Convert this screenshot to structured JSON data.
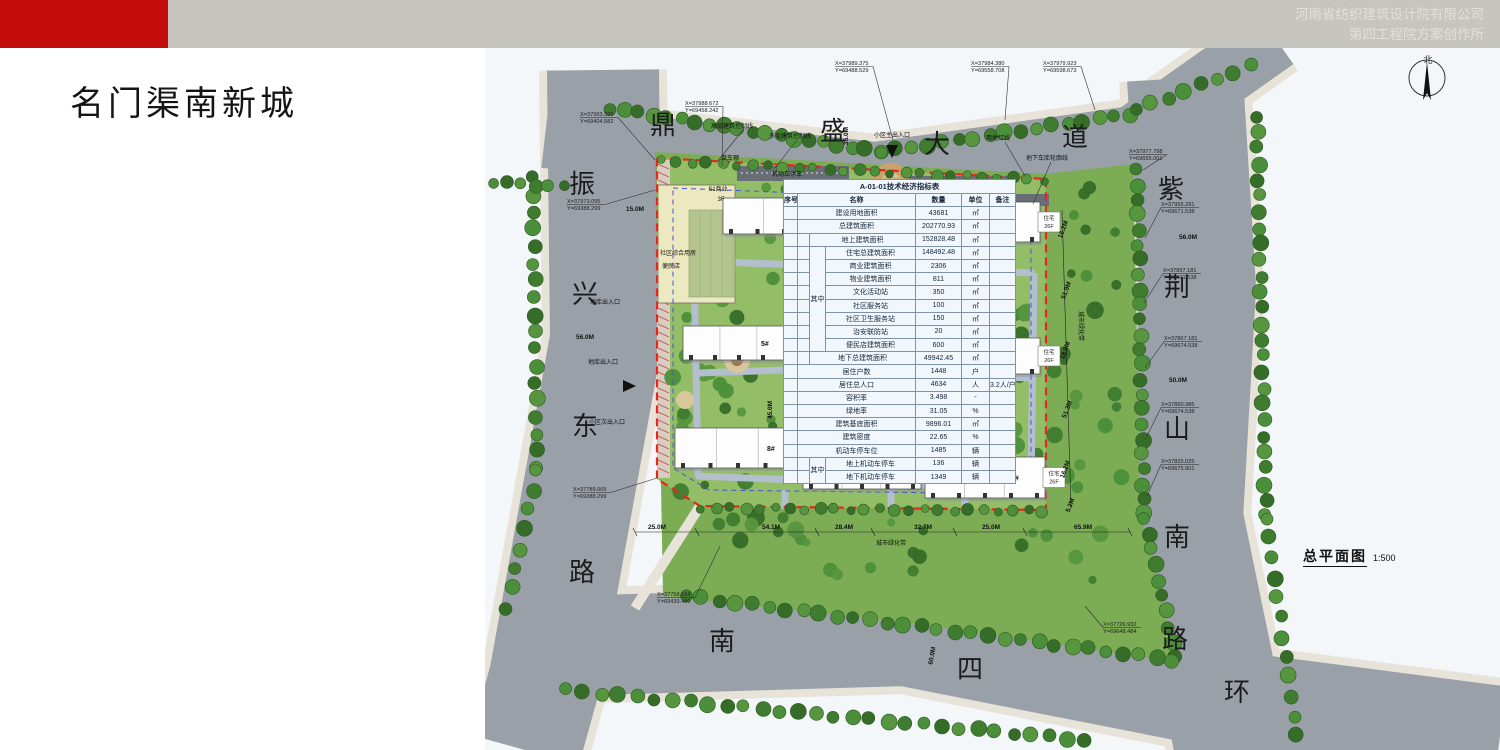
{
  "header": {
    "company_line1": "河南省纺织建筑设计院有限公司",
    "company_line2": "第四工程院方案创作所",
    "accent_color": "#c30d0d",
    "bar_color": "#c7c5bf"
  },
  "title": "名门渠南新城",
  "plan": {
    "caption": {
      "text": "总平面图",
      "scale": "1:500"
    },
    "north_label": "北",
    "colors": {
      "road": "#9aa0a8",
      "lawn": "#93bd66",
      "belt": "#7cad55",
      "boundary_red": "#e8271c",
      "garage_blue": "#4854d8"
    },
    "road_names": [
      {
        "ch": "振",
        "x": 97,
        "y": 145
      },
      {
        "ch": "兴",
        "x": 100,
        "y": 255
      },
      {
        "ch": "东",
        "x": 100,
        "y": 387
      },
      {
        "ch": "路",
        "x": 97,
        "y": 533
      },
      {
        "ch": "鼎",
        "x": 178,
        "y": 86
      },
      {
        "ch": "盛",
        "x": 348,
        "y": 92
      },
      {
        "ch": "大",
        "x": 452,
        "y": 105
      },
      {
        "ch": "道",
        "x": 590,
        "y": 98
      },
      {
        "ch": "紫",
        "x": 686,
        "y": 150
      },
      {
        "ch": "荆",
        "x": 692,
        "y": 248
      },
      {
        "ch": "山",
        "x": 692,
        "y": 390
      },
      {
        "ch": "南",
        "x": 692,
        "y": 498
      },
      {
        "ch": "路",
        "x": 690,
        "y": 600
      },
      {
        "ch": "南",
        "x": 237,
        "y": 602
      },
      {
        "ch": "四",
        "x": 485,
        "y": 630
      },
      {
        "ch": "环",
        "x": 752,
        "y": 653
      }
    ],
    "coords": [
      {
        "x": 95,
        "y": 63,
        "X": "X=37993.320",
        "Y": "Y=69404.582",
        "tx": 170,
        "ty": 112
      },
      {
        "x": 200,
        "y": 52,
        "X": "X=37988.672",
        "Y": "Y=69458.242",
        "tx": 237,
        "ty": 118
      },
      {
        "x": 350,
        "y": 12,
        "X": "X=37989.375",
        "Y": "Y=69488.529",
        "tx": 408,
        "ty": 92
      },
      {
        "x": 486,
        "y": 12,
        "X": "X=37984.380",
        "Y": "Y=69558.708",
        "tx": 520,
        "ty": 72
      },
      {
        "x": 558,
        "y": 12,
        "X": "X=37979.923",
        "Y": "Y=69598.673",
        "tx": 610,
        "ty": 62
      },
      {
        "x": 644,
        "y": 100,
        "X": "X=37977.798",
        "Y": "Y=69655.001",
        "tx": 658,
        "ty": 122
      },
      {
        "x": 676,
        "y": 153,
        "X": "X=37955.291",
        "Y": "Y=69671.538",
        "tx": 660,
        "ty": 190
      },
      {
        "x": 678,
        "y": 219,
        "X": "X=37897.181",
        "Y": "Y=69671.538",
        "tx": 659,
        "ty": 255
      },
      {
        "x": 679,
        "y": 287,
        "X": "X=37867.181",
        "Y": "Y=69674.538",
        "tx": 660,
        "ty": 320
      },
      {
        "x": 676,
        "y": 353,
        "X": "X=37860.986",
        "Y": "Y=69674.538",
        "tx": 660,
        "ty": 392
      },
      {
        "x": 676,
        "y": 410,
        "X": "X=37825.025",
        "Y": "Y=69675.901",
        "tx": 662,
        "ty": 448
      },
      {
        "x": 82,
        "y": 150,
        "X": "X=37973.095",
        "Y": "Y=69388.299",
        "tx": 170,
        "ty": 142
      },
      {
        "x": 88,
        "y": 438,
        "X": "X=37789.065",
        "Y": "Y=69388.299",
        "tx": 172,
        "ty": 430
      },
      {
        "x": 172,
        "y": 543,
        "X": "X=37758.164",
        "Y": "Y=69439.480",
        "tx": 235,
        "ty": 498
      },
      {
        "x": 618,
        "y": 573,
        "X": "X=37726.932",
        "Y": "Y=69648.484",
        "tx": 600,
        "ty": 558
      }
    ],
    "dims": [
      {
        "t": "35.0M",
        "x": 363,
        "y": 88,
        "r": -90
      },
      {
        "t": "29.6M",
        "x": 407,
        "y": 172,
        "r": 0
      },
      {
        "t": "96.0M",
        "x": 390,
        "y": 291,
        "r": 0
      },
      {
        "t": "45.0M",
        "x": 287,
        "y": 362,
        "r": -90
      },
      {
        "t": "15.0M",
        "x": 150,
        "y": 163,
        "r": 0
      },
      {
        "t": "56.0M",
        "x": 100,
        "y": 291,
        "r": 0
      },
      {
        "t": "56.0M",
        "x": 703,
        "y": 191,
        "r": 0
      },
      {
        "t": "50.0M",
        "x": 693,
        "y": 334,
        "r": 0
      },
      {
        "t": "60.0M",
        "x": 449,
        "y": 608,
        "r": -80
      },
      {
        "t": "16.2M",
        "x": 580,
        "y": 182,
        "r": -70
      },
      {
        "t": "51.9M",
        "x": 583,
        "y": 243,
        "r": -70
      },
      {
        "t": "18.9M",
        "x": 582,
        "y": 303,
        "r": -70
      },
      {
        "t": "51.3M",
        "x": 584,
        "y": 362,
        "r": -70
      },
      {
        "t": "16.2M",
        "x": 582,
        "y": 422,
        "r": -70
      },
      {
        "t": "5.2M",
        "x": 587,
        "y": 458,
        "r": -70
      },
      {
        "t": "25.0M",
        "x": 172,
        "y": 481,
        "r": 0
      },
      {
        "t": "54.1M",
        "x": 286,
        "y": 481,
        "r": 0
      },
      {
        "t": "28.4M",
        "x": 359,
        "y": 481,
        "r": 0
      },
      {
        "t": "32.7M",
        "x": 438,
        "y": 481,
        "r": 0
      },
      {
        "t": "25.0M",
        "x": 506,
        "y": 481,
        "r": 0
      },
      {
        "t": "65.9M",
        "x": 598,
        "y": 481,
        "r": 0
      }
    ],
    "annotations": [
      {
        "t": "高层建筑控制线",
        "x": 247,
        "y": 80,
        "r": 0
      },
      {
        "t": "多层建筑控制线",
        "x": 305,
        "y": 90,
        "r": 0
      },
      {
        "t": "小区主出入口",
        "x": 407,
        "y": 89,
        "r": 0
      },
      {
        "t": "用地红线",
        "x": 513,
        "y": 92,
        "r": 0
      },
      {
        "t": "地下车库轮廓线",
        "x": 562,
        "y": 112,
        "r": 0
      },
      {
        "t": "机动车停车",
        "x": 302,
        "y": 128,
        "r": 0
      },
      {
        "t": "单车棚",
        "x": 245,
        "y": 112,
        "r": 0
      },
      {
        "t": "地库出入口",
        "x": 120,
        "y": 256,
        "r": 0
      },
      {
        "t": "地库出入口",
        "x": 118,
        "y": 316,
        "r": 0
      },
      {
        "t": "小区次出入口",
        "x": 122,
        "y": 376,
        "r": 0
      },
      {
        "t": "城市绿化带",
        "x": 594,
        "y": 278,
        "r": 90
      },
      {
        "t": "城市绿化带",
        "x": 406,
        "y": 497,
        "r": 0
      },
      {
        "t": "社区综合用房",
        "x": 193,
        "y": 207,
        "r": 0
      },
      {
        "t": "便民店",
        "x": 186,
        "y": 220,
        "r": 0
      },
      {
        "t": "S1商业",
        "x": 233,
        "y": 143,
        "r": 0
      },
      {
        "t": "3F",
        "x": 236,
        "y": 153,
        "r": 0
      }
    ],
    "buildings": [
      {
        "id": "2#",
        "x": 238,
        "y": 150,
        "w": 122,
        "h": 36,
        "use": "住宅",
        "floors": "26F"
      },
      {
        "id": "1#",
        "x": 420,
        "y": 154,
        "w": 135,
        "h": 40,
        "use": "住宅",
        "floors": "26F"
      },
      {
        "id": "5#",
        "x": 198,
        "y": 278,
        "w": 112,
        "h": 34,
        "use": "住宅",
        "floors": "26F"
      },
      {
        "id": "3#",
        "x": 452,
        "y": 290,
        "w": 103,
        "h": 36,
        "use": "住宅",
        "floors": "26F"
      },
      {
        "id": "8#",
        "x": 190,
        "y": 380,
        "w": 126,
        "h": 40,
        "use": "住宅",
        "floors": "26F"
      },
      {
        "id": "7#",
        "x": 318,
        "y": 403,
        "w": 118,
        "h": 38,
        "use": "住宅",
        "floors": "26F"
      },
      {
        "id": "6#",
        "x": 440,
        "y": 409,
        "w": 120,
        "h": 41,
        "use": "住宅",
        "floors": "26F"
      }
    ]
  },
  "table": {
    "title": "A-01-01技术经济指标表",
    "headers": [
      "序号",
      "名称",
      "数量",
      "单位",
      "备注"
    ],
    "group_label": "其中",
    "rows": [
      {
        "type": "full",
        "name": "建设用地面积",
        "qty": "43681",
        "unit": "㎡",
        "note": ""
      },
      {
        "type": "full",
        "name": "总建筑面积",
        "qty": "202770.93",
        "unit": "㎡",
        "note": ""
      },
      {
        "type": "sub",
        "name": "地上建筑面积",
        "qty": "152828.48",
        "unit": "㎡",
        "note": ""
      },
      {
        "type": "gstart",
        "span": 8,
        "name": "住宅总建筑面积",
        "qty": "148492.48",
        "unit": "㎡",
        "note": ""
      },
      {
        "type": "g",
        "name": "商业建筑面积",
        "qty": "2306",
        "unit": "㎡",
        "note": ""
      },
      {
        "type": "g",
        "name": "物业建筑面积",
        "qty": "811",
        "unit": "㎡",
        "note": ""
      },
      {
        "type": "g",
        "name": "文化活动站",
        "qty": "350",
        "unit": "㎡",
        "note": ""
      },
      {
        "type": "g",
        "name": "社区服务站",
        "qty": "100",
        "unit": "㎡",
        "note": ""
      },
      {
        "type": "g",
        "name": "社区卫生服务站",
        "qty": "150",
        "unit": "㎡",
        "note": ""
      },
      {
        "type": "g",
        "name": "治安联防站",
        "qty": "20",
        "unit": "㎡",
        "note": ""
      },
      {
        "type": "g",
        "name": "便民店建筑面积",
        "qty": "600",
        "unit": "㎡",
        "note": ""
      },
      {
        "type": "sub",
        "name": "地下总建筑面积",
        "qty": "49942.45",
        "unit": "㎡",
        "note": ""
      },
      {
        "type": "full",
        "name": "居住户数",
        "qty": "1448",
        "unit": "户",
        "note": ""
      },
      {
        "type": "full",
        "name": "居住总人口",
        "qty": "4634",
        "unit": "人",
        "note": "3.2人/户"
      },
      {
        "type": "full",
        "name": "容积率",
        "qty": "3.498",
        "unit": "-",
        "note": ""
      },
      {
        "type": "full",
        "name": "绿地率",
        "qty": "31.05",
        "unit": "%",
        "note": ""
      },
      {
        "type": "full",
        "name": "建筑基底面积",
        "qty": "9896.01",
        "unit": "㎡",
        "note": ""
      },
      {
        "type": "full",
        "name": "建筑密度",
        "qty": "22.65",
        "unit": "%",
        "note": ""
      },
      {
        "type": "full",
        "name": "机动车停车位",
        "qty": "1485",
        "unit": "辆",
        "note": ""
      },
      {
        "type": "gstart",
        "span": 2,
        "name": "地上机动车停车",
        "qty": "136",
        "unit": "辆",
        "note": ""
      },
      {
        "type": "g",
        "name": "地下机动车停车",
        "qty": "1349",
        "unit": "辆",
        "note": ""
      }
    ]
  }
}
